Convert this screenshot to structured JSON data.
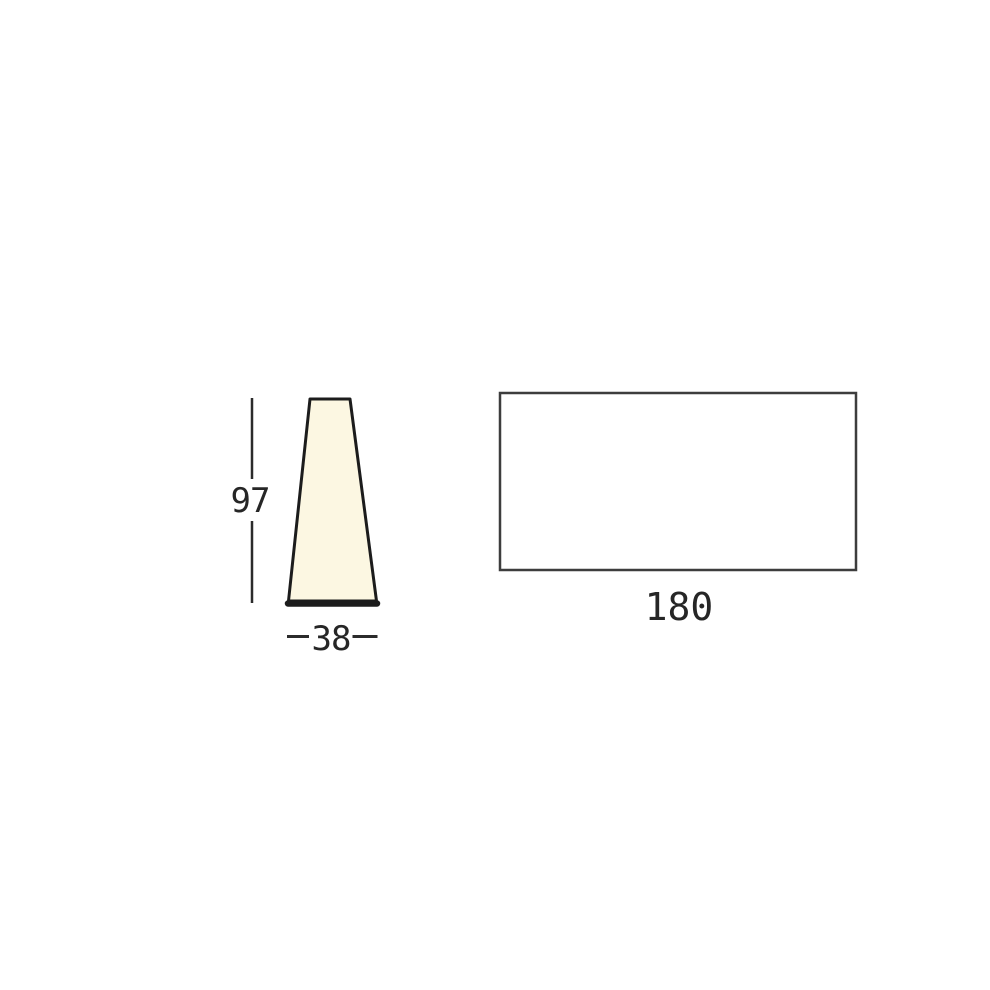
{
  "diagram": {
    "type": "product-dimension-drawing",
    "views": {
      "left": {
        "shape": "tapered-cone-front-view",
        "height": "97",
        "width": "38"
      },
      "right": {
        "shape": "rectangular-panel-view",
        "width": "180"
      }
    },
    "colors": {
      "background": "#ffffff",
      "cone_fill": "#fcf7e2",
      "cone_outline": "#1c1c1c",
      "panel_fill": "#ffffff",
      "panel_outline": "#3d3d3d",
      "dimension_line": "#2b2b2b",
      "label_text": "#262626"
    }
  }
}
